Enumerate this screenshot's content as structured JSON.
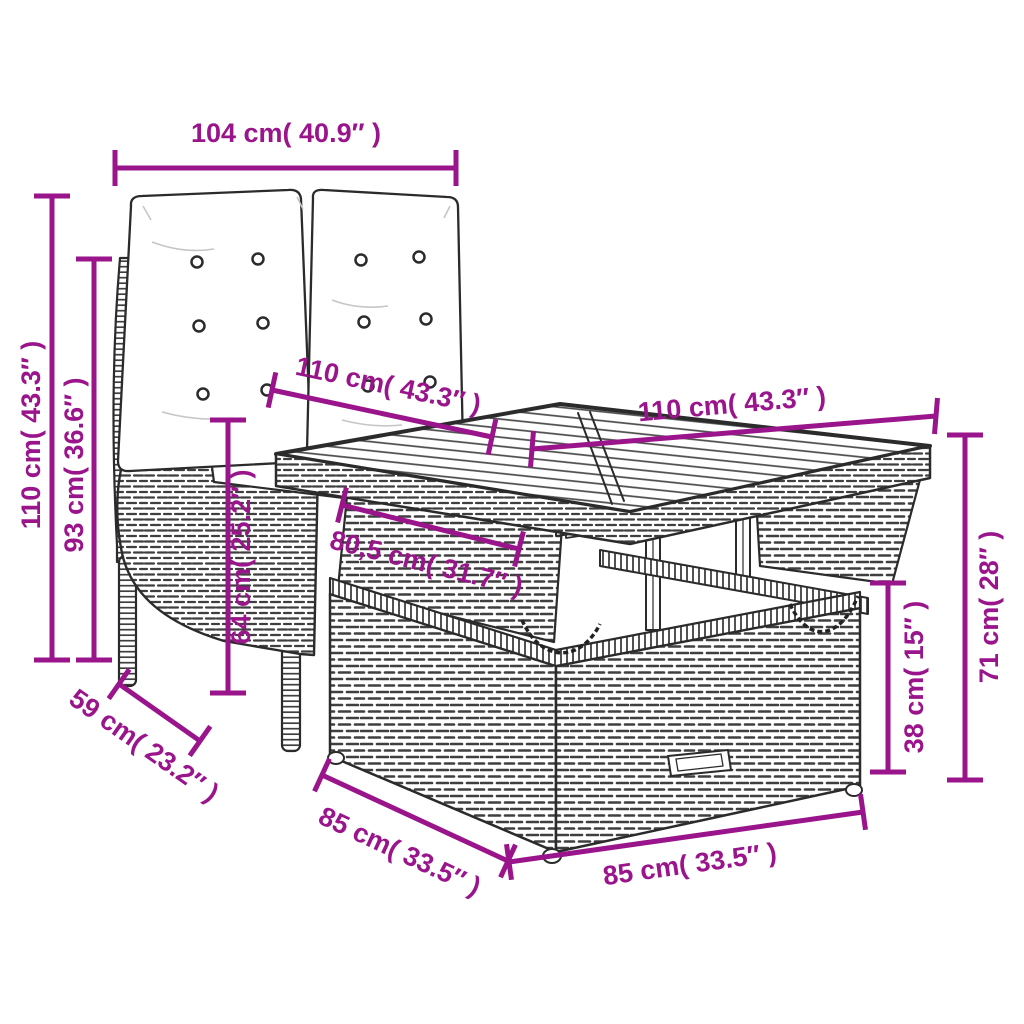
{
  "figure": {
    "kind": "product-dimension-diagram",
    "subject": "Poly rattan garden set: reclining 2-seater bench with tufted cushions and height-adjustable lift-top table",
    "background_color": "#ffffff",
    "accent_color": "#9A148B",
    "line_color": "#2b2b2b"
  },
  "dimensions": {
    "backrest_width": {
      "label": "104 cm( 40.9″ )",
      "cm": 104,
      "inches": 40.9
    },
    "bench_total_height": {
      "label": "110 cm( 43.3″ )",
      "cm": 110,
      "inches": 43.3
    },
    "bench_backrest_height": {
      "label": "93 cm( 36.6″ )",
      "cm": 93,
      "inches": 36.6
    },
    "table_top_depth": {
      "label": "110 cm( 43.3″ )",
      "cm": 110,
      "inches": 43.3
    },
    "table_top_width": {
      "label": "110 cm( 43.3″ )",
      "cm": 110,
      "inches": 43.3
    },
    "table_clearance_width": {
      "label": "80,5 cm( 31.7″ )",
      "cm": 80.5,
      "inches": 31.7
    },
    "bench_seat_height": {
      "label": "64 cm( 25.2″ )",
      "cm": 64,
      "inches": 25.2
    },
    "bench_depth": {
      "label": "59 cm( 23.2″ )",
      "cm": 59,
      "inches": 23.2
    },
    "table_base_depth": {
      "label": "85 cm( 33.5″ )",
      "cm": 85,
      "inches": 33.5
    },
    "table_base_width": {
      "label": "85 cm( 33.5″ )",
      "cm": 85,
      "inches": 33.5
    },
    "table_base_height": {
      "label": "38 cm( 15″ )",
      "cm": 38,
      "inches": 15
    },
    "table_height": {
      "label": "71 cm( 28″ )",
      "cm": 71,
      "inches": 28
    }
  }
}
